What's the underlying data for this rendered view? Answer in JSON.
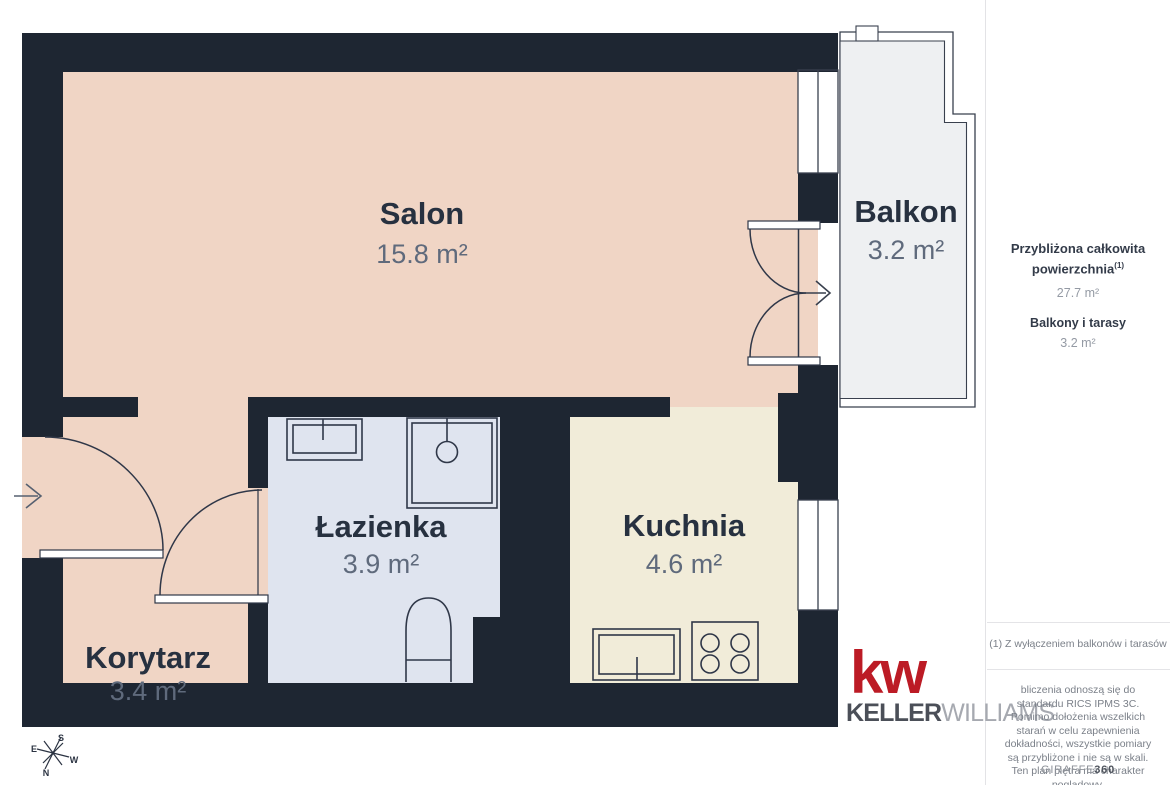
{
  "floorplan": {
    "wall_color": "#1e2632",
    "rooms": [
      {
        "name": "Salon",
        "area": "15.8 m²",
        "floor_color": "#f0d5c5"
      },
      {
        "name": "Balkon",
        "area": "3.2 m²",
        "floor_color": "#eef0f2"
      },
      {
        "name": "Łazienka",
        "area": "3.9 m²",
        "floor_color": "#dfe4ef"
      },
      {
        "name": "Kuchnia",
        "area": "4.6 m²",
        "floor_color": "#f1ecd9"
      },
      {
        "name": "Korytarz",
        "area": "3.4 m²",
        "floor_color": "#f0d5c5"
      }
    ],
    "compass": {
      "n": "N",
      "s": "S",
      "e": "E",
      "w": "W"
    }
  },
  "sidebar": {
    "summary_title": "Przybliżona całkowita powierzchnia",
    "summary_sup": "(1)",
    "summary_value": "27.7 m²",
    "balconies_label": "Balkony i tarasy",
    "balconies_value": "3.2 m²",
    "footnote": "(1) Z wyłączeniem balkonów i tarasów",
    "disclaimer": "bliczenia odnoszą się do standardu RICS IPMS 3C. Pomimo dołożenia wszelkich starań w celu zapewnienia dokładności, wszystkie pomiary są przybliżone i nie są w skali. Ten plan piętra ma charakter poglądowy.",
    "brand": {
      "giraffe": "GIRAFFE",
      "num": "360"
    }
  },
  "logo": {
    "mark": "kw",
    "keller": "KELLER",
    "williams": "WILLIAMS",
    "red": "#bc1b25"
  }
}
